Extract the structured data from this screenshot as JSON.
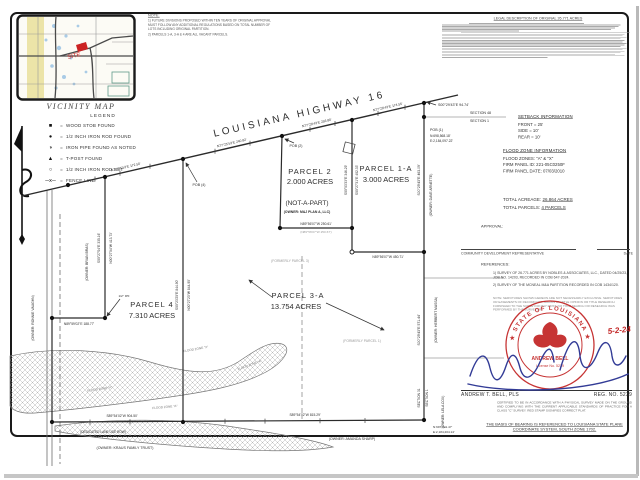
{
  "vicinity": {
    "label": "VICINITY MAP",
    "site_label": "SITE",
    "site_color": "#cc2222"
  },
  "notes": {
    "heading": "NOTE:",
    "items": [
      "1)  FUTURE DIVISIONS PROPOSED WITHIN TEN YEARS OF ORIGINAL APPROVAL MUST FOLLOW ANY ADDITIONAL REGULATIONS BASED ON TOTAL NUMBER OF LOTS INCLUDING ORIGINAL PARTITION.",
      "2)  PARCELS 1-A, 3-A & 4 ARE ALL VACANT PARCELS."
    ]
  },
  "legend": {
    "heading": "LEGEND",
    "items": [
      {
        "symbol": "■",
        "label": "WOOD STOB FOUND"
      },
      {
        "symbol": "●",
        "label": "1/2 INCH IRON ROD FOUND"
      },
      {
        "symbol": "◑",
        "label": "IRON PIPE FOUND AS NOTED"
      },
      {
        "symbol": "▲",
        "label": "T-POST FOUND"
      },
      {
        "symbol": "○",
        "label": "1/2 INCH IRON ROD SET"
      },
      {
        "symbol": "─x─",
        "label": "FENCE LINE"
      }
    ]
  },
  "legal": {
    "title": "LEGAL DESCRIPTION OF ORIGINAL 26.771 ACRES"
  },
  "panel": {
    "setback": {
      "heading": "SETBACK INFORMATION",
      "rows": [
        "FRONT = 25'",
        "SIDE = 10'",
        "REAR = 10'"
      ]
    },
    "flood": {
      "heading": "FLOOD ZONE INFORMATION",
      "rows": [
        "FLOOD ZONES: \"A\" & \"X\"",
        "FIRM PANEL ID: 221-05C0250F",
        "FIRM PANEL DATE: 07/03/2010"
      ]
    },
    "total_acreage_label": "TOTAL ACREAGE:",
    "total_acreage_value": "26.864 ACRES",
    "total_parcels_label": "TOTAL PARCELS:",
    "total_parcels_value": "4 PARCELS",
    "approval_label": "APPROVAL:",
    "approval_sig_label": "COMMUNITY DEVELOPMENT REPRESENTATIVE",
    "approval_date_label": "DATE",
    "references_heading": "REFERENCES:",
    "references": [
      "1)  SURVEY OF 26.771 ACRES BY NOBLES & ASSOCIATES, LLC., DATED 04/25/23, JOB NO. 14203, RECORDED IN COB 647-2024.",
      "2)  SURVEY OF THE MCNEAL M&A PARTITION RECORDED IN COB 1434/120."
    ],
    "servitude_note": "NOTE:  SERVITUDES SHOWN HEREON ARE NOT NECESSARILY EXCLUSIVE.  SERVITUDES OR EASEMENTS OF RECORD NOT SHOWN ON TITLE OPINION OR TITLE RESEARCH FURNISHED TO THE SURVEYOR MAY EXIST.  NO TITLE SEARCH OR RESEARCH WAS PERFORMED BY THE SURVEYOR."
  },
  "seal": {
    "ring_text": "★ STATE OF LOUISIANA ★",
    "name": "ANDREW BELL",
    "license": "License No. 5239",
    "date": "5-2-24",
    "color": "#c22323",
    "signature_color": "#323b96"
  },
  "surveyor": {
    "name_line": "ANDREW T. BELL, PLS",
    "reg_line": "REG. NO. 5239",
    "cert": "CERTIFIED TO BE IN ACCORDANCE WITH A PHYSICAL SURVEY MADE ON THE GROUND AND COMPLYING WITH THE CURRENT APPLICABLE STANDARDS OF PRACTICE FOR A CLASS \"C\" SURVEY.  RED STAMP SIGNIFIES CORRECT PLAT."
  },
  "basis_note": "THE BASIS OF BEARING IS REFERENCED TO LOUISIANA STATE PLANE COORDINATE SYSTEM, SOUTH ZONE 1702.",
  "map": {
    "labels": [
      {
        "n": "highway-label",
        "t": "LOUISIANA  HIGHWAY  16",
        "x": 300,
        "y": 117,
        "r": -13,
        "s": 10,
        "ls": 3
      },
      {
        "n": "parcel-2-label",
        "t": "PARCEL 2",
        "x": 310,
        "y": 174,
        "s": 7.5,
        "ls": 1
      },
      {
        "n": "parcel-2-acres",
        "t": "2.000 ACRES",
        "x": 310,
        "y": 184,
        "s": 7.5
      },
      {
        "n": "parcel-2-notapart",
        "t": "(NOT-A-PART)",
        "x": 307,
        "y": 205,
        "s": 6.5
      },
      {
        "n": "parcel-2-owner",
        "t": "(OWNER: M&J PLAN A, LLC)",
        "x": 307,
        "y": 213,
        "s": 3.4,
        "w": "bold"
      },
      {
        "n": "parcel-1a-label",
        "t": "PARCEL 1-A",
        "x": 386,
        "y": 171,
        "s": 7.5,
        "ls": 1
      },
      {
        "n": "parcel-1a-acres",
        "t": "3.000 ACRES",
        "x": 386,
        "y": 182,
        "s": 7.5
      },
      {
        "n": "parcel-4-label",
        "t": "PARCEL 4",
        "x": 152,
        "y": 307,
        "s": 7.5,
        "ls": 1
      },
      {
        "n": "parcel-4-acres",
        "t": "7.310 ACRES",
        "x": 152,
        "y": 318,
        "s": 7.5
      },
      {
        "n": "parcel-3a-label",
        "t": "PARCEL 3-A",
        "x": 298,
        "y": 298,
        "s": 7.5,
        "ls": 1
      },
      {
        "n": "parcel-3a-acres",
        "t": "13.754 ACRES",
        "x": 296,
        "y": 309,
        "s": 7.5
      },
      {
        "n": "formerly-parcel-3",
        "t": "(FORMERLY PARCEL 3)",
        "x": 290,
        "y": 262,
        "s": 3.4,
        "c": "#9a9a9a"
      },
      {
        "n": "formerly-parcel-1",
        "t": "(FORMERLY PARCEL 1)",
        "x": 362,
        "y": 342,
        "s": 3.4,
        "c": "#9a9a9a"
      },
      {
        "n": "pob-2",
        "t": "POB (2)",
        "x": 296,
        "y": 147,
        "s": 3.6
      },
      {
        "n": "pob-4",
        "t": "POB (4)",
        "x": 199,
        "y": 186,
        "s": 3.6
      },
      {
        "n": "pob-1",
        "t": "POB (1)",
        "x": 430,
        "y": 131,
        "s": 3.6,
        "a": "start"
      },
      {
        "n": "pob-1-north",
        "t": "N:698,568.18'",
        "x": 430,
        "y": 137,
        "s": 3.3,
        "a": "start"
      },
      {
        "n": "pob-1-east",
        "t": "E:2,184,097.22'",
        "x": 430,
        "y": 142,
        "s": 3.3,
        "a": "start"
      },
      {
        "n": "bearing",
        "t": "S00°29'43\"E  94.74'",
        "x": 438,
        "y": 106,
        "s": 3.6,
        "a": "start"
      },
      {
        "n": "section-48",
        "t": "SECTION 48",
        "x": 470,
        "y": 114,
        "s": 3.6,
        "a": "start"
      },
      {
        "n": "section-1-top",
        "t": "SECTION 1",
        "x": 470,
        "y": 122,
        "s": 3.6,
        "a": "start"
      },
      {
        "n": "owner-dave-arnette",
        "t": "(OWNER: DAVE ARNETTE)",
        "x": 432,
        "y": 195,
        "s": 3.4,
        "r": -90
      },
      {
        "n": "bearing",
        "t": "S00°29'43\"E  463.09'",
        "x": 420,
        "y": 180,
        "s": 3.4,
        "r": -90
      },
      {
        "n": "bearing",
        "t": "S00°29'43\"E  571.44'",
        "x": 420,
        "y": 330,
        "s": 3.4,
        "r": -90
      },
      {
        "n": "owner-herbert-massa",
        "t": "(OWNER: HERBERT MASSA)",
        "x": 437,
        "y": 320,
        "s": 3.4,
        "r": -90
      },
      {
        "n": "section-31",
        "t": "SECTION 31",
        "x": 420,
        "y": 398,
        "s": 3.3,
        "r": -90
      },
      {
        "n": "section-1-bottom",
        "t": "SECTION 1",
        "x": 428,
        "y": 398,
        "s": 3.3,
        "r": -90
      },
      {
        "n": "owner-lela-cox",
        "t": "(OWNER: LELA COX)",
        "x": 444,
        "y": 412,
        "s": 3.3,
        "r": -90
      },
      {
        "n": "corner-north",
        "t": "N:697,141.47'",
        "x": 433,
        "y": 428,
        "s": 3.1,
        "a": "start"
      },
      {
        "n": "corner-east",
        "t": "E:2,184,204.14'",
        "x": 433,
        "y": 433,
        "s": 3.1,
        "a": "start"
      },
      {
        "n": "owner-amanda-sharp",
        "t": "(OWNER: AMANDA SHARP)",
        "x": 352,
        "y": 440,
        "s": 3.6
      },
      {
        "n": "owner-kraus-trust",
        "t": "(OWNER: KRAUS FAMILY TRUST)",
        "x": 125,
        "y": 449,
        "s": 3.6
      },
      {
        "n": "lane-row-label",
        "t": "(DEDICATED LANE USE ROW)",
        "x": 103,
        "y": 433,
        "s": 3.2
      },
      {
        "n": "owner-ronnie-vaughn",
        "t": "(OWNER: RONNIE VAUGHN)",
        "x": 34,
        "y": 318,
        "s": 3.4,
        "r": -90
      },
      {
        "n": "owner-brian-bras",
        "t": "(OWNER: BRIAN BRAS)",
        "x": 88,
        "y": 262,
        "s": 3.4,
        "r": -90
      },
      {
        "n": "bearing",
        "t": "S00°27'04\"E  335.16'",
        "x": 100,
        "y": 248,
        "s": 3.3,
        "r": -90
      },
      {
        "n": "bearing",
        "t": "N00°27'04\"W  413.73'",
        "x": 112,
        "y": 248,
        "s": 3.3,
        "r": -90
      },
      {
        "n": "bearing",
        "t": "N89°59'02\"E  188.77'",
        "x": 79,
        "y": 325,
        "s": 3.3
      },
      {
        "n": "ipf-note",
        "t": "1/2\" IPF",
        "x": 124,
        "y": 297,
        "s": 3.1
      },
      {
        "n": "bearing",
        "t": "S00°23'25\"E  844.90'",
        "x": 178,
        "y": 295,
        "s": 3.3,
        "r": -90
      },
      {
        "n": "bearing",
        "t": "N00°27'23\"W  844.90'",
        "x": 190,
        "y": 295,
        "s": 3.3,
        "r": -90
      },
      {
        "n": "bearing",
        "t": "S00°03'33\"E  346.29'",
        "x": 347,
        "y": 180,
        "s": 3.3,
        "r": -90
      },
      {
        "n": "bearing",
        "t": "S00°27'31\"E  402.33'",
        "x": 358,
        "y": 180,
        "s": 3.3,
        "r": -90
      },
      {
        "n": "bearing",
        "t": "N89°56'07\"W  250.61'",
        "x": 316,
        "y": 225,
        "s": 3.3
      },
      {
        "n": "bearing-record",
        "t": "(N89°56'07\"W  250.67')",
        "x": 316,
        "y": 233,
        "s": 3.1,
        "c": "#999"
      },
      {
        "n": "bearing",
        "t": "N89°56'07\"W  450.71'",
        "x": 388,
        "y": 258,
        "s": 3.3
      },
      {
        "n": "bearing",
        "t": "N77°25'53\"E  172.50'",
        "x": 126,
        "y": 168,
        "s": 3.3,
        "r": -13
      },
      {
        "n": "bearing",
        "t": "N77°25'53\"E  240.82'",
        "x": 232,
        "y": 144,
        "s": 3.3,
        "r": -13
      },
      {
        "n": "bearing",
        "t": "N77°29'43\"E  256.80'",
        "x": 317,
        "y": 124,
        "s": 3.3,
        "r": -13
      },
      {
        "n": "bearing",
        "t": "N77°29'43\"E  174.55'",
        "x": 388,
        "y": 108,
        "s": 3.3,
        "r": -13
      },
      {
        "n": "bearing",
        "t": "S89°54'02\"W  904.50'",
        "x": 122,
        "y": 417,
        "s": 3.3
      },
      {
        "n": "bearing",
        "t": "S89°54'02\"W  815.29'",
        "x": 305,
        "y": 416,
        "s": 3.3
      },
      {
        "n": "flood-zone-a",
        "t": "FLOOD ZONE \"A\"",
        "x": 100,
        "y": 390,
        "s": 3.1,
        "r": -8,
        "c": "#777"
      },
      {
        "n": "flood-zone-a",
        "t": "FLOOD ZONE \"A\"",
        "x": 165,
        "y": 408,
        "s": 3.1,
        "r": -5,
        "c": "#777"
      },
      {
        "n": "flood-zone-a",
        "t": "FLOOD ZONE \"A\"",
        "x": 250,
        "y": 366,
        "s": 3.1,
        "r": -20,
        "c": "#777"
      },
      {
        "n": "flood-zone-x",
        "t": "FLOOD ZONE \"X\"",
        "x": 196,
        "y": 350,
        "s": 3.1,
        "r": -10,
        "c": "#777"
      }
    ]
  }
}
